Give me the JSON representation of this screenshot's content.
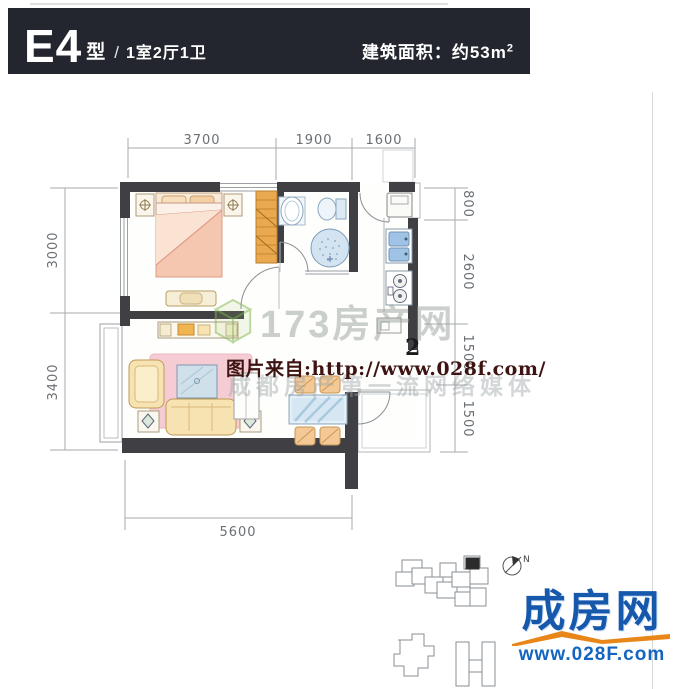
{
  "header": {
    "unit_code": "E4",
    "unit_suffix": "型",
    "separator": "/",
    "layout": "1室2厅1卫",
    "area_label": "建筑面积：约53m",
    "area_exponent": "2"
  },
  "dimensions": {
    "top": [
      "3700",
      "1900",
      "1600"
    ],
    "left": [
      "3000",
      "3400"
    ],
    "right": [
      "800",
      "2600",
      "1500",
      "1500"
    ],
    "bottom": [
      "5600"
    ]
  },
  "watermarks": {
    "brand": "173房产网",
    "slogan": "成都房产第一流网络媒体",
    "source_note": "图片来自:http://www.028f.com/",
    "stray_superscript": "2"
  },
  "logo": {
    "name": "成房网",
    "website": "www.028F.com"
  },
  "compass": {
    "label": "N"
  },
  "colors": {
    "header_bg": "#23262e",
    "wall": "#3f3f44",
    "wardrobe_orange": "#eaa94f",
    "rug_pink": "#f6ccd4",
    "sofa_cream": "#f7e3b2",
    "glass_blue": "#cfe0ea",
    "logo_blue": "#1658ac",
    "logo_orange": "#e8861a",
    "source_text_red": "#3d1412"
  }
}
